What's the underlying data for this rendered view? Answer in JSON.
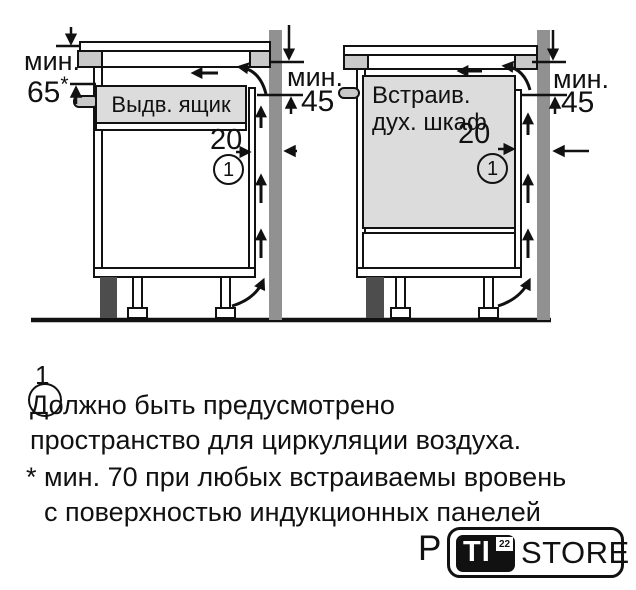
{
  "diagram_left": {
    "drawer_label": "Выдв. ящик",
    "dim_min_label": "мин.",
    "dim_min_value": "65",
    "dim_min_footnote_mark": "*",
    "dim_wall_label": "мин.",
    "dim_wall_value": "45",
    "gap_value": "20",
    "callout_number": "1"
  },
  "diagram_right": {
    "oven_label_line1": "Встраив.",
    "oven_label_line2": "дух. шкаф",
    "dim_wall_label": "мин.",
    "dim_wall_value": "45",
    "gap_value": "20",
    "callout_number": "1"
  },
  "footnote": {
    "callout_number": "1",
    "line1": "Должно быть предусмотрено",
    "line2": "пространство для циркуляции воздуха.",
    "asterisk_line1": "* мин. 70 при любых встраиваемы вровень",
    "asterisk_line2": "с поверхностью индукционных панелей"
  },
  "watermark": {
    "prefix": "P",
    "logo_text": "TI",
    "logo_superscript": "22",
    "logo_suffix": "STORE"
  },
  "colors": {
    "wall_gray": "#919191",
    "plinth_dark": "#4d4d4d",
    "worktop_gray": "#c9c9c9",
    "appliance_gray": "#dcdcdc",
    "line_black": "#111111"
  }
}
